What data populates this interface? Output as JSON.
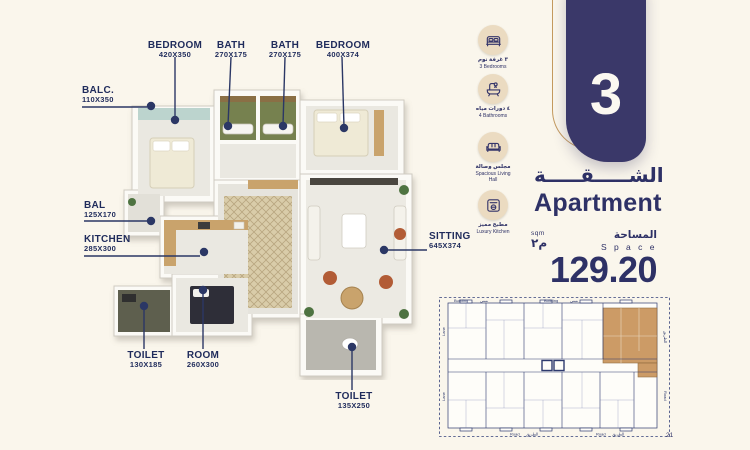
{
  "page": {
    "background": "#FAF6EC",
    "page_number": "21"
  },
  "unit_tab": {
    "number": "3"
  },
  "title": {
    "arabic": "الشـــــقـــــة",
    "english": "Apartment"
  },
  "area": {
    "sqm_label": "sqm",
    "sqm_arabic": "م٢",
    "space_arabic": "المساحة",
    "space_english": "S p a c e",
    "value": "129.20"
  },
  "amenities": [
    {
      "icon": "bed-icon",
      "arabic": "٣ غرفة نوم",
      "english": "3 Bedrooms"
    },
    {
      "icon": "bathtub-icon",
      "arabic": "٤ دورات مياه",
      "english": "4 Bathrooms"
    },
    {
      "icon": "sofa-icon",
      "arabic": "مجلس وصالة",
      "english": "Spacious Living Hall"
    },
    {
      "icon": "kitchen-icon",
      "arabic": "مطبخ مميز",
      "english": "Luxury Kitchen"
    }
  ],
  "floorplan": {
    "labels": [
      {
        "name": "BEDROOM",
        "dims": "420X350"
      },
      {
        "name": "BATH",
        "dims": "270X175"
      },
      {
        "name": "BATH",
        "dims": "270X175"
      },
      {
        "name": "BEDROOM",
        "dims": "400X374"
      },
      {
        "name": "BALC.",
        "dims": "110X350"
      },
      {
        "name": "BAL",
        "dims": "125X170"
      },
      {
        "name": "KITCHEN",
        "dims": "285X300"
      },
      {
        "name": "TOILET",
        "dims": "130X185"
      },
      {
        "name": "ROOM",
        "dims": "260X300"
      },
      {
        "name": "TOILET",
        "dims": "135X250"
      },
      {
        "name": "SITTING",
        "dims": "645X374"
      }
    ]
  },
  "keyplan": {
    "building_en": "Building",
    "building_ar": "مبنى",
    "road_en": "Road",
    "road_ar": "الطريق",
    "lane_en": "Lane",
    "highlight_color": "#C9945B"
  },
  "colors": {
    "navy": "#2E3166",
    "tab_navy": "#3A3869",
    "gold": "#C49A5F",
    "icon_circle": "#EBDBC1",
    "background": "#FAF6EC"
  }
}
